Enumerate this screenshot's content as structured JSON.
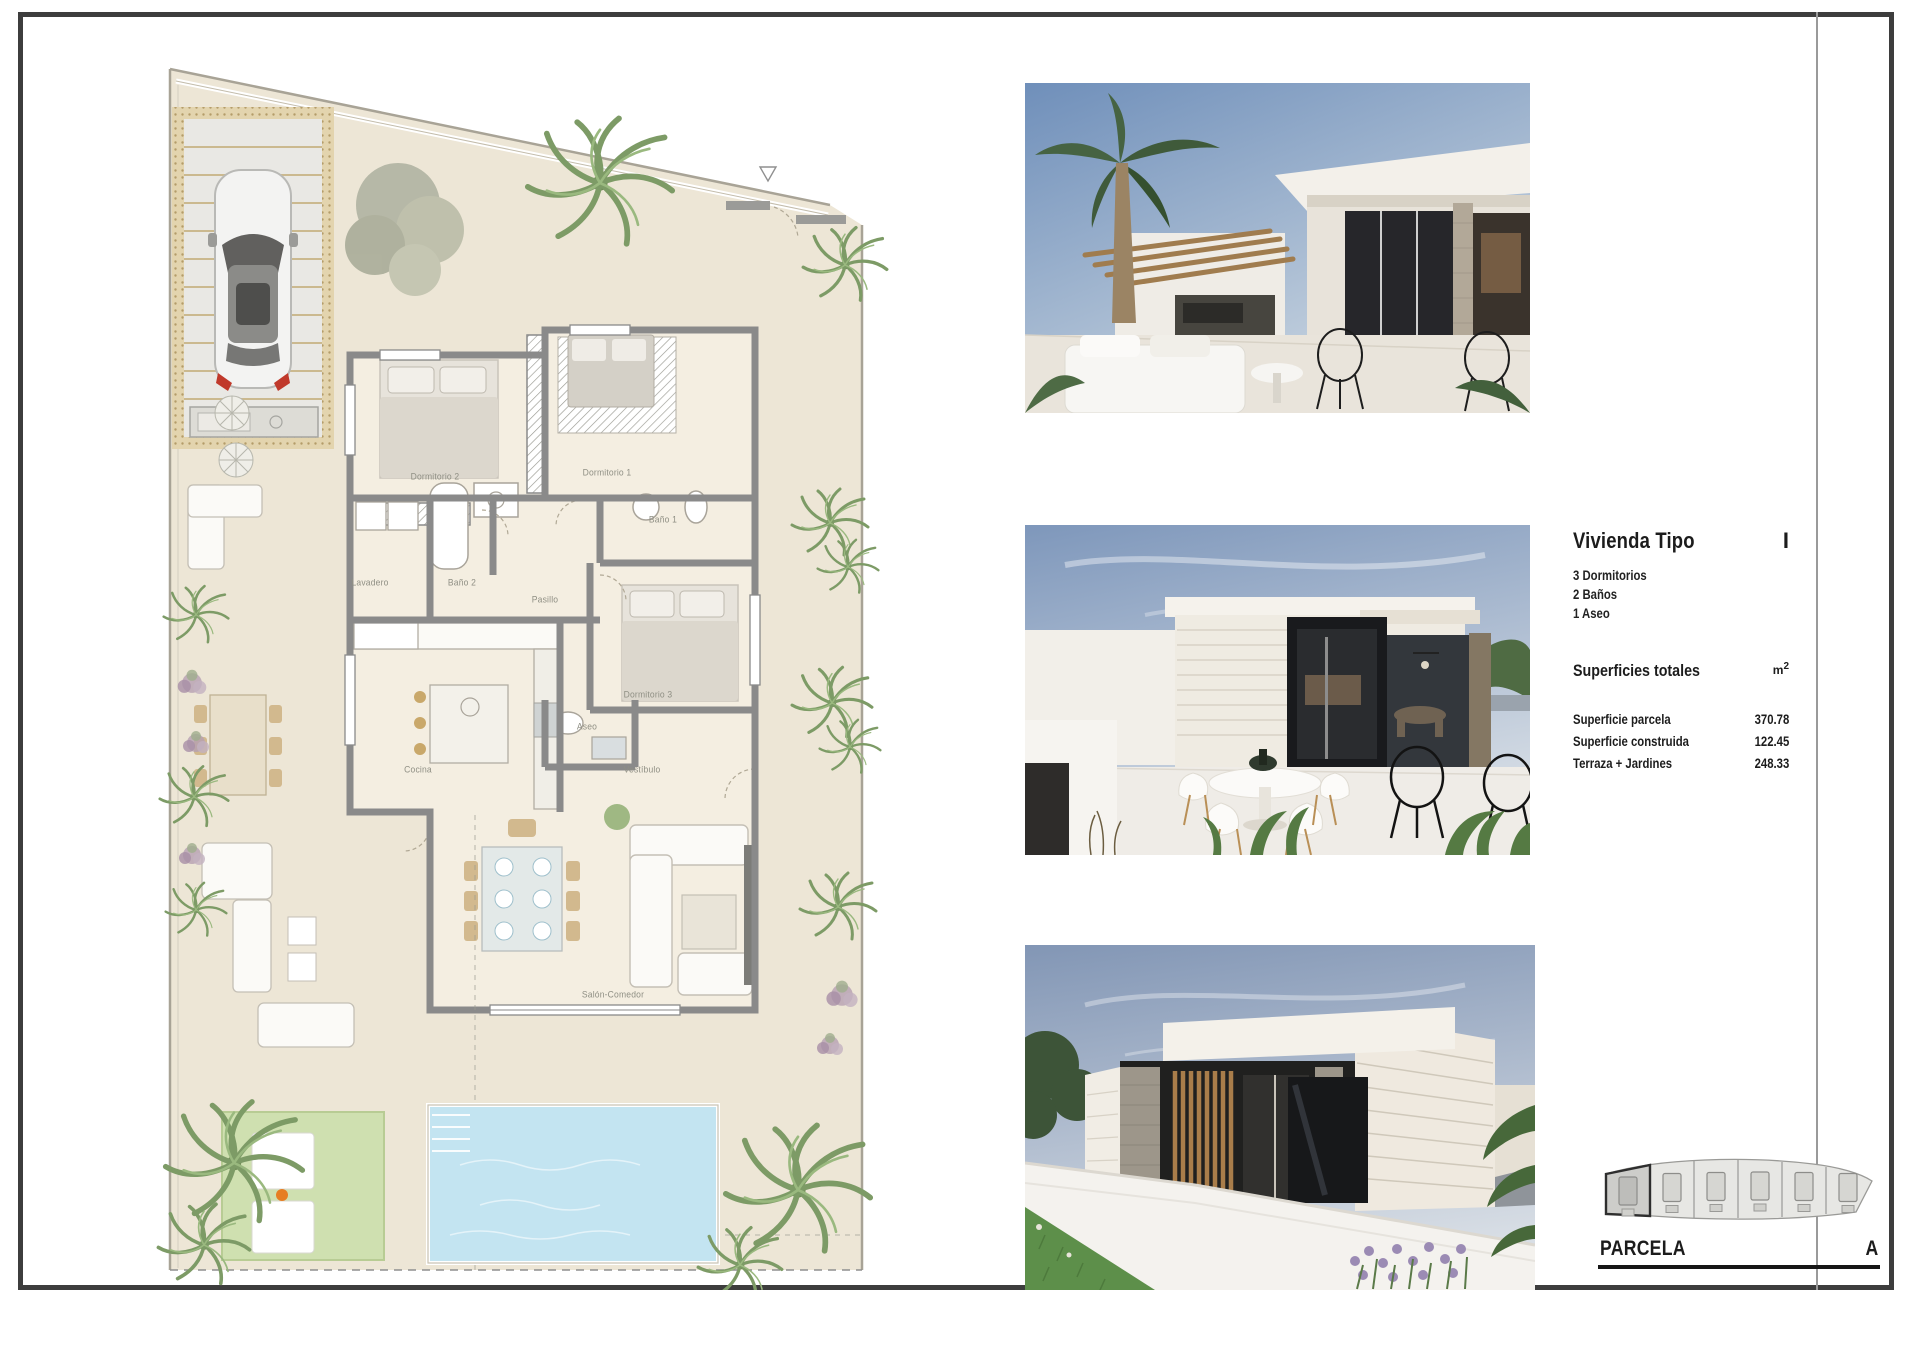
{
  "panel": {
    "title": "Vivienda Tipo",
    "type_letter": "I",
    "features": [
      "3 Dormitorios",
      "2 Baños",
      "1 Aseo"
    ],
    "superficies_title": "Superficies totales",
    "unit_base": "m",
    "unit_exp": "2",
    "rows": [
      {
        "label": "Superficie parcela",
        "value": "370.78"
      },
      {
        "label": "Superficie construida",
        "value": "122.45"
      },
      {
        "label": "Terraza + Jardines",
        "value": "248.33"
      }
    ]
  },
  "parcela": {
    "label": "PARCELA",
    "letter": "A",
    "plots_total": 6,
    "highlighted_plot": 1
  },
  "floorplan": {
    "rooms": [
      {
        "name": "Dormitorio 2",
        "x": 305,
        "y": 422
      },
      {
        "name": "Dormitorio 1",
        "x": 477,
        "y": 418
      },
      {
        "name": "Baño 1",
        "x": 533,
        "y": 465
      },
      {
        "name": "Lavadero",
        "x": 240,
        "y": 528
      },
      {
        "name": "Baño 2",
        "x": 332,
        "y": 528
      },
      {
        "name": "Pasillo",
        "x": 415,
        "y": 545
      },
      {
        "name": "Dormitorio 3",
        "x": 518,
        "y": 640
      },
      {
        "name": "Aseo",
        "x": 457,
        "y": 672
      },
      {
        "name": "Cocina",
        "x": 288,
        "y": 715
      },
      {
        "name": "Vestíbulo",
        "x": 512,
        "y": 715
      },
      {
        "name": "Salón-Comedor",
        "x": 483,
        "y": 940
      }
    ]
  },
  "renders": [
    {
      "name": "terrace-pergola-view"
    },
    {
      "name": "terrace-dining-view"
    },
    {
      "name": "street-facade-view"
    }
  ],
  "colors": {
    "frame": "#3d3d3d",
    "ground": "#ede6d6",
    "wall": "#8a8a8a",
    "pool": "#c3e4f1",
    "lawn": "#cfe0b0",
    "pergola": "#d9c9a4"
  }
}
